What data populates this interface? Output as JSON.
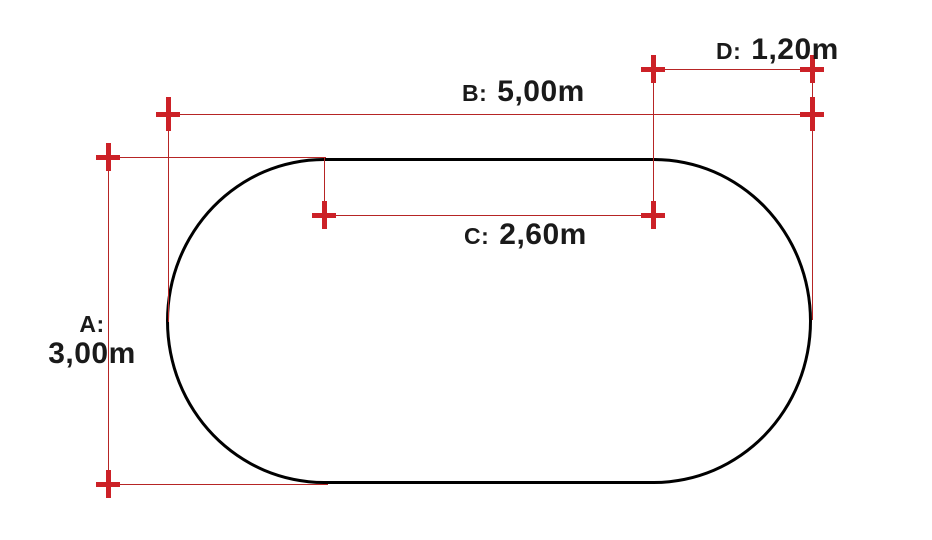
{
  "diagram": {
    "shape": "rounded-oval-outline",
    "dimensions": [
      {
        "id": "A",
        "label": "A:",
        "value": "3,00m",
        "orientation": "vertical"
      },
      {
        "id": "B",
        "label": "B:",
        "value": "5,00m",
        "orientation": "horizontal"
      },
      {
        "id": "C",
        "label": "C:",
        "value": "2,60m",
        "orientation": "horizontal"
      },
      {
        "id": "D",
        "label": "D:",
        "value": "1,20m",
        "orientation": "horizontal"
      }
    ],
    "colors": {
      "dimension_lines": "#b62525",
      "cross_markers": "#cc2127",
      "shape_outline": "#000000",
      "label_text": "#1a1a1a",
      "background": "#ffffff"
    }
  }
}
